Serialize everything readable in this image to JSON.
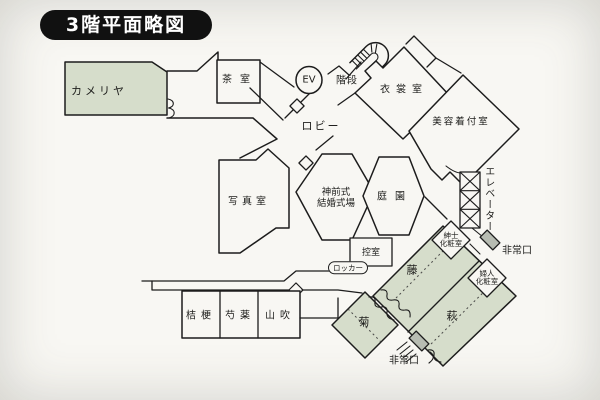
{
  "title": "3階平面略図",
  "colors": {
    "paper": "#f8f7f3",
    "wall": "#1c1c1c",
    "room_green": "#d6ddcb",
    "exit_gray": "#b7bcb2",
    "title_bg": "#111111",
    "title_fg": "#ffffff"
  },
  "rooms": {
    "kameriya": {
      "label": "カメリヤ"
    },
    "chashitsu": {
      "label": "茶室"
    },
    "ev": {
      "label": "EV"
    },
    "kaidan": {
      "label": "階段"
    },
    "ishoshitsu": {
      "label": "衣裳室"
    },
    "biyo_kitsuke": {
      "label": "美容着付室"
    },
    "lobby": {
      "label": "ロビー"
    },
    "shashinshitsu": {
      "label": "写真室"
    },
    "shinzenshiki": {
      "line1": "神前式",
      "line2": "結婚式場"
    },
    "teien": {
      "label": "庭園"
    },
    "elevator": {
      "label": "エレベーター"
    },
    "hijoguchi_upper": {
      "label": "非常口"
    },
    "shinshi_keshoshitsu": {
      "line1": "紳士",
      "line2": "化粧室"
    },
    "fujin_keshoshitsu": {
      "line1": "婦人",
      "line2": "化粧室"
    },
    "fuji": {
      "label": "藤"
    },
    "hagi": {
      "label": "萩"
    },
    "kiku": {
      "label": "菊"
    },
    "hijoguchi_lower": {
      "label": "非常口"
    },
    "hikaeshitsu": {
      "label": "控室"
    },
    "locker": {
      "label": "ロッカー"
    },
    "kikyo": {
      "label": "桔梗"
    },
    "shakuyaku": {
      "label": "芍薬"
    },
    "yamabuki": {
      "label": "山吹"
    }
  }
}
